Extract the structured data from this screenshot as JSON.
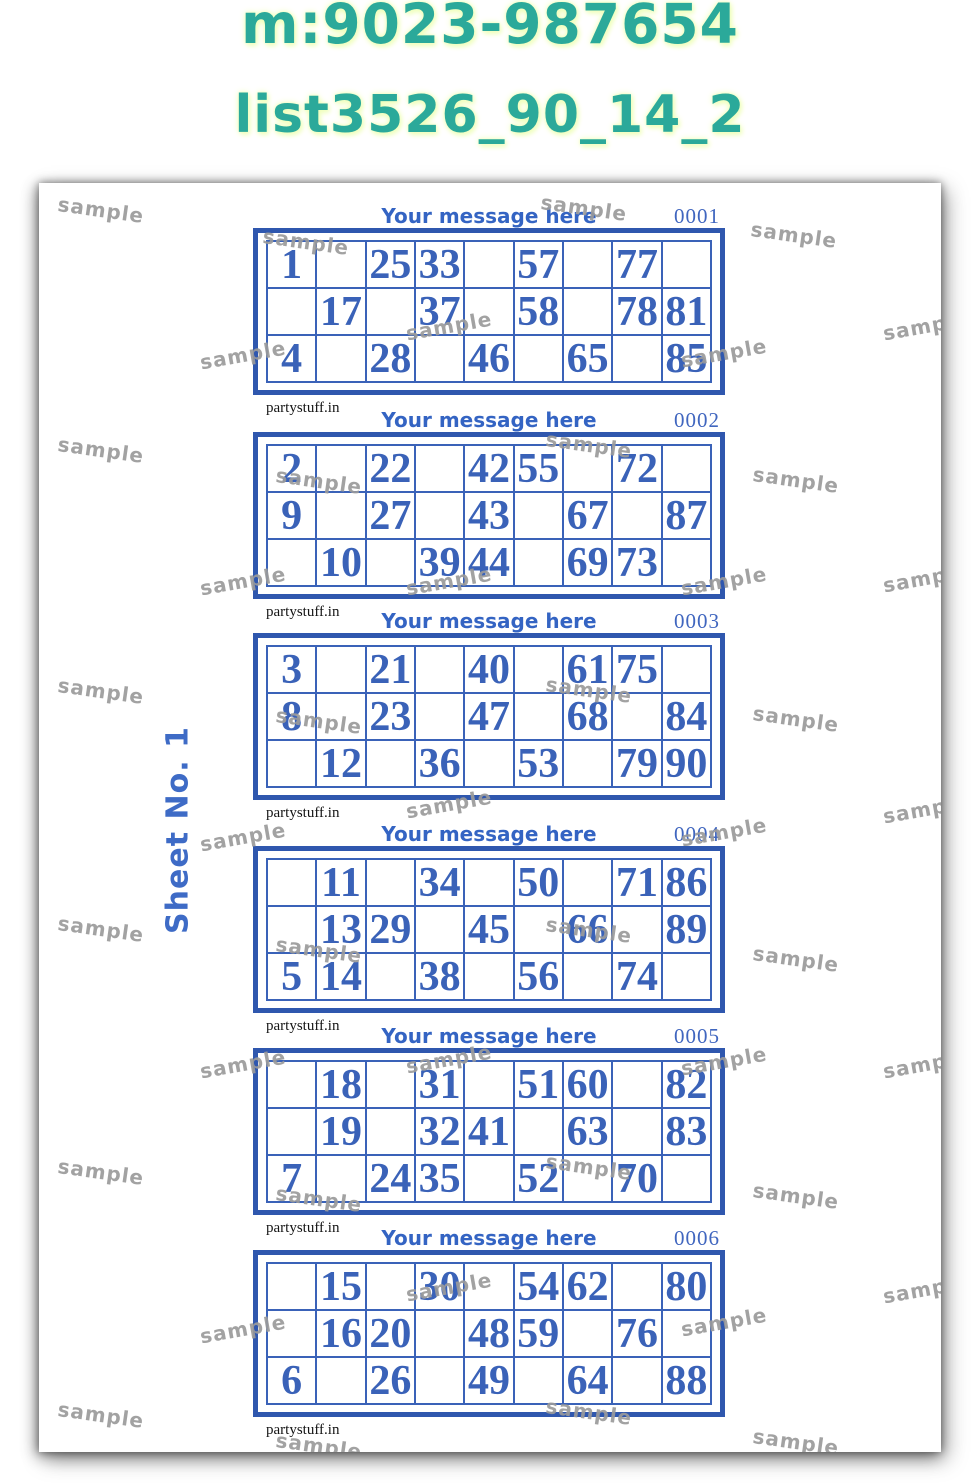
{
  "header": {
    "phone_line": "m:9023-987654",
    "list_line": "list3526_90_14_2"
  },
  "sheet": {
    "label": "Sheet No. 1",
    "message": "Your message here",
    "brand": "partystuff.in"
  },
  "colors": {
    "teal": "#2ba99a",
    "blue": "#3a62b8",
    "thick_border_blue": "#2f57ae",
    "message_blue": "#3464c3",
    "watermark_gray": "#9b9b9b"
  },
  "watermark": {
    "text": "sample",
    "positions": [
      [
        62,
        27,
        8
      ],
      [
        267,
        59,
        8
      ],
      [
        545,
        25,
        8
      ],
      [
        755,
        52,
        8
      ],
      [
        887,
        143,
        -10
      ],
      [
        204,
        172,
        -10
      ],
      [
        410,
        143,
        -10
      ],
      [
        685,
        170,
        -10
      ],
      [
        62,
        267,
        8
      ],
      [
        550,
        262,
        8
      ],
      [
        280,
        298,
        8
      ],
      [
        757,
        297,
        8
      ],
      [
        204,
        398,
        -10
      ],
      [
        410,
        398,
        -10
      ],
      [
        685,
        398,
        -10
      ],
      [
        887,
        395,
        -10
      ],
      [
        62,
        508,
        8
      ],
      [
        550,
        507,
        8
      ],
      [
        280,
        538,
        8
      ],
      [
        757,
        536,
        8
      ],
      [
        410,
        621,
        -10
      ],
      [
        887,
        626,
        -10
      ],
      [
        204,
        654,
        -10
      ],
      [
        685,
        649,
        -10
      ],
      [
        62,
        746,
        8
      ],
      [
        550,
        747,
        8
      ],
      [
        280,
        767,
        8
      ],
      [
        757,
        776,
        8
      ],
      [
        204,
        881,
        -10
      ],
      [
        410,
        876,
        -10
      ],
      [
        685,
        878,
        -10
      ],
      [
        887,
        881,
        -10
      ],
      [
        62,
        989,
        8
      ],
      [
        550,
        984,
        8
      ],
      [
        280,
        1016,
        8
      ],
      [
        757,
        1013,
        8
      ],
      [
        410,
        1104,
        -10
      ],
      [
        887,
        1106,
        -10
      ],
      [
        204,
        1146,
        -10
      ],
      [
        685,
        1139,
        -10
      ],
      [
        62,
        1232,
        8
      ],
      [
        550,
        1229,
        8
      ],
      [
        280,
        1263,
        8
      ],
      [
        757,
        1259,
        8
      ]
    ]
  },
  "tickets": [
    {
      "number": "0001",
      "rows": [
        [
          "1",
          "",
          "25",
          "33",
          "",
          "57",
          "",
          "77",
          ""
        ],
        [
          "",
          "17",
          "",
          "37",
          "",
          "58",
          "",
          "78",
          "81"
        ],
        [
          "4",
          "",
          "28",
          "",
          "46",
          "",
          "65",
          "",
          "85"
        ]
      ]
    },
    {
      "number": "0002",
      "rows": [
        [
          "2",
          "",
          "22",
          "",
          "42",
          "55",
          "",
          "72",
          ""
        ],
        [
          "9",
          "",
          "27",
          "",
          "43",
          "",
          "67",
          "",
          "87"
        ],
        [
          "",
          "10",
          "",
          "39",
          "44",
          "",
          "69",
          "73",
          ""
        ]
      ]
    },
    {
      "number": "0003",
      "rows": [
        [
          "3",
          "",
          "21",
          "",
          "40",
          "",
          "61",
          "75",
          ""
        ],
        [
          "8",
          "",
          "23",
          "",
          "47",
          "",
          "68",
          "",
          "84"
        ],
        [
          "",
          "12",
          "",
          "36",
          "",
          "53",
          "",
          "79",
          "90"
        ]
      ]
    },
    {
      "number": "0004",
      "rows": [
        [
          "",
          "11",
          "",
          "34",
          "",
          "50",
          "",
          "71",
          "86"
        ],
        [
          "",
          "13",
          "29",
          "",
          "45",
          "",
          "66",
          "",
          "89"
        ],
        [
          "5",
          "14",
          "",
          "38",
          "",
          "56",
          "",
          "74",
          ""
        ]
      ]
    },
    {
      "number": "0005",
      "rows": [
        [
          "",
          "18",
          "",
          "31",
          "",
          "51",
          "60",
          "",
          "82"
        ],
        [
          "",
          "19",
          "",
          "32",
          "41",
          "",
          "63",
          "",
          "83"
        ],
        [
          "7",
          "",
          "24",
          "35",
          "",
          "52",
          "",
          "70",
          ""
        ]
      ]
    },
    {
      "number": "0006",
      "rows": [
        [
          "",
          "15",
          "",
          "30",
          "",
          "54",
          "62",
          "",
          "80"
        ],
        [
          "",
          "16",
          "20",
          "",
          "48",
          "59",
          "",
          "76",
          ""
        ],
        [
          "6",
          "",
          "26",
          "",
          "49",
          "",
          "64",
          "",
          "88"
        ]
      ]
    }
  ]
}
